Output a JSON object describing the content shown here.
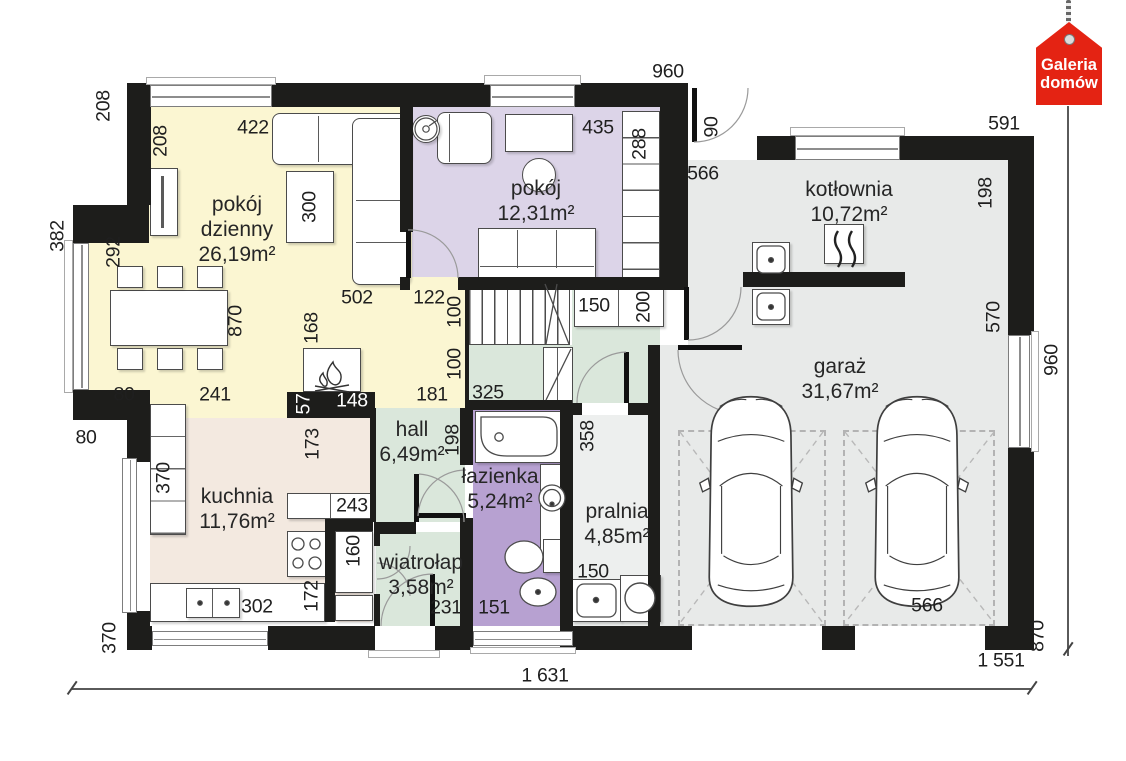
{
  "brand": {
    "line1": "Galeria",
    "line2": "domów"
  },
  "rooms": [
    {
      "name": "pokój dzienny",
      "area": "26,19m²"
    },
    {
      "name": "pokój",
      "area": "12,31m²"
    },
    {
      "name": "kotłownia",
      "area": "10,72m²"
    },
    {
      "name": "garaż",
      "area": "31,67m²"
    },
    {
      "name": "kuchnia",
      "area": "11,76m²"
    },
    {
      "name": "hall",
      "area": "6,49m²"
    },
    {
      "name": "łazienka",
      "area": "5,24m²"
    },
    {
      "name": "pralnia",
      "area": "4,85m²"
    },
    {
      "name": "wiatrołap",
      "area": "3,58m²"
    }
  ],
  "dimensions": [
    {
      "t": "208",
      "x": 104,
      "y": 106,
      "r": 1
    },
    {
      "t": "422",
      "x": 253,
      "y": 128
    },
    {
      "t": "208",
      "x": 161,
      "y": 141,
      "r": 1
    },
    {
      "t": "960",
      "x": 668,
      "y": 72
    },
    {
      "t": "435",
      "x": 598,
      "y": 128
    },
    {
      "t": "288",
      "x": 640,
      "y": 144,
      "r": 1
    },
    {
      "t": "90",
      "x": 712,
      "y": 127,
      "r": 1
    },
    {
      "t": "591",
      "x": 1004,
      "y": 124
    },
    {
      "t": "566",
      "x": 703,
      "y": 174
    },
    {
      "t": "198",
      "x": 986,
      "y": 193,
      "r": 1
    },
    {
      "t": "382",
      "x": 58,
      "y": 236,
      "r": 1
    },
    {
      "t": "292",
      "x": 114,
      "y": 252,
      "r": 1
    },
    {
      "t": "300",
      "x": 310,
      "y": 207,
      "r": 1
    },
    {
      "t": "870",
      "x": 236,
      "y": 321,
      "r": 1
    },
    {
      "t": "502",
      "x": 357,
      "y": 298
    },
    {
      "t": "122",
      "x": 429,
      "y": 298
    },
    {
      "t": "100",
      "x": 455,
      "y": 312,
      "r": 1
    },
    {
      "t": "150",
      "x": 594,
      "y": 306
    },
    {
      "t": "200",
      "x": 644,
      "y": 307,
      "r": 1
    },
    {
      "t": "570",
      "x": 994,
      "y": 317,
      "r": 1
    },
    {
      "t": "168",
      "x": 312,
      "y": 328,
      "r": 1
    },
    {
      "t": "100",
      "x": 455,
      "y": 364,
      "r": 1
    },
    {
      "t": "80",
      "x": 124,
      "y": 395
    },
    {
      "t": "241",
      "x": 215,
      "y": 395
    },
    {
      "t": "57",
      "x": 304,
      "y": 404,
      "r": 1,
      "inv": 1
    },
    {
      "t": "148",
      "x": 352,
      "y": 401,
      "inv": 1
    },
    {
      "t": "181",
      "x": 432,
      "y": 395
    },
    {
      "t": "325",
      "x": 488,
      "y": 393
    },
    {
      "t": "80",
      "x": 86,
      "y": 438
    },
    {
      "t": "173",
      "x": 313,
      "y": 444,
      "r": 1
    },
    {
      "t": "198",
      "x": 453,
      "y": 440,
      "r": 1
    },
    {
      "t": "358",
      "x": 588,
      "y": 436,
      "r": 1
    },
    {
      "t": "370",
      "x": 164,
      "y": 478,
      "r": 1
    },
    {
      "t": "243",
      "x": 352,
      "y": 506
    },
    {
      "t": "160",
      "x": 354,
      "y": 551,
      "r": 1
    },
    {
      "t": "172",
      "x": 312,
      "y": 596,
      "r": 1
    },
    {
      "t": "302",
      "x": 257,
      "y": 607
    },
    {
      "t": "231",
      "x": 446,
      "y": 608
    },
    {
      "t": "151",
      "x": 494,
      "y": 608
    },
    {
      "t": "150",
      "x": 593,
      "y": 572
    },
    {
      "t": "566",
      "x": 927,
      "y": 606
    },
    {
      "t": "370",
      "x": 110,
      "y": 638,
      "r": 1
    },
    {
      "t": "870",
      "x": 1038,
      "y": 636,
      "r": 1
    },
    {
      "t": "960",
      "x": 1052,
      "y": 360,
      "r": 1
    },
    {
      "t": "1 631",
      "x": 545,
      "y": 676
    },
    {
      "t": "1 551",
      "x": 1001,
      "y": 661
    }
  ],
  "icons": {
    "fireplace-icon": "flame",
    "boiler-icon": "heat-waves",
    "sink-icon": "basin-with-drain",
    "washer-icon": "drum-circle",
    "brand-tag-icon": "hanging-house-tag"
  },
  "colors": {
    "wall": "#1d1d1b",
    "living": "#FBF6D2",
    "room_purple": "#DCD4E8",
    "bath_purple": "#B7A1D1",
    "green": "#DAE7DB",
    "gray": "#E8EAE9",
    "laundry": "#EDEFEE",
    "kitchen": "#F3E9E0",
    "logo_red": "#E42313",
    "dim_text": "#1f1f1f"
  }
}
